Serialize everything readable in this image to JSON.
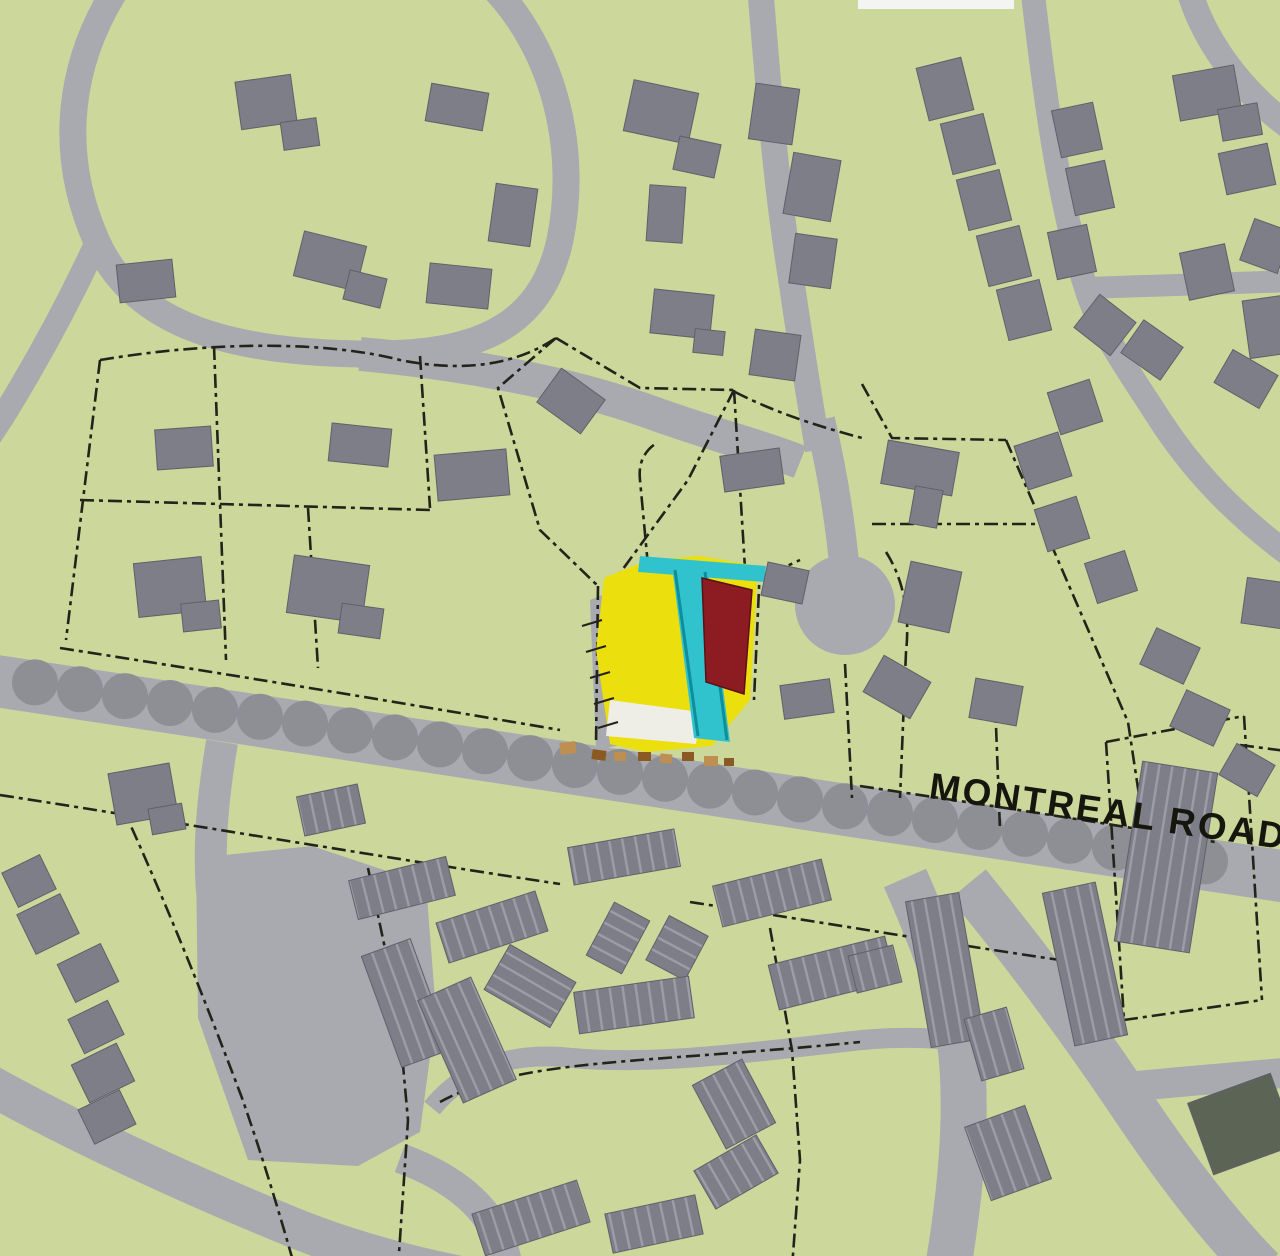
{
  "map": {
    "road_label": "MONTREAL ROAD",
    "colors": {
      "background": "#ccd79b",
      "road": "#a9a9b0",
      "building": "#7e7e88",
      "building_stroke": "#60606a",
      "townhouse_stripe": "#9d9da7",
      "tree": "#8e8e95",
      "parcel_line": "#23231a",
      "site_yellow": "#ecdf0e",
      "site_cyan": "#31c3cd",
      "site_teal_edge": "#0e8d9b",
      "site_red": "#8d1c22",
      "site_red_edge": "#5a1014",
      "parking_white": "#efeee6",
      "driveway_gray": "#9a9aa0",
      "tick_black": "#222218",
      "tan_dark": "#8a5a22",
      "tan_light": "#bd8f50",
      "dark_building": "#5c6456",
      "top_sliver": "#f4f4f2"
    },
    "roads": [
      {
        "d": "M 118,-14 C 70,60 56,150 97,242 C 136,328 235,352 360,354 C 470,356 540,332 560,240 C 578,152 556,52 492,-14",
        "w": 27
      },
      {
        "d": "M 97,242 C 70,300 38,360 2,418 L -10,436",
        "w": 24
      },
      {
        "d": "M 360,354 C 450,362 560,380 650,412 C 710,434 760,446 800,462",
        "w": 34
      },
      {
        "d": "M 760,-14 C 768,80 775,180 791,278 C 797,320 808,390 818,450",
        "w": 26
      },
      {
        "d": "M 820,420 C 832,470 840,520 845,572",
        "w": 30
      },
      {
        "d": "M 1032,-14 C 1044,90 1058,200 1086,288 C 1099,330 1124,364 1160,420 C 1190,466 1226,506 1280,548 L 1294,558",
        "w": 24
      },
      {
        "d": "M 1086,288 C 1150,286 1220,283 1294,281",
        "w": 22
      },
      {
        "d": "M 1188,-14 C 1202,38 1240,92 1294,130",
        "w": 26
      },
      {
        "d": "M -10,680 L 1294,878",
        "w": 52
      },
      {
        "d": "M -10,1085 C 80,1135 190,1185 280,1222 C 350,1252 420,1268 470,1278",
        "w": 40
      },
      {
        "d": "M 400,1158 C 460,1180 500,1215 508,1268",
        "w": 30
      },
      {
        "d": "M 222,742 C 214,790 208,840 212,892",
        "w": 32
      },
      {
        "d": "M 905,878 C 930,935 950,985 960,1042 C 968,1105 962,1185 948,1268",
        "w": 46
      },
      {
        "d": "M 432,1108 C 470,1062 520,1052 572,1058 C 660,1066 770,1050 862,1040 C 905,1036 940,1038 962,1042",
        "w": 20
      },
      {
        "d": "M 968,884 C 1022,950 1076,1022 1126,1096 C 1170,1162 1216,1224 1262,1270",
        "w": 46
      },
      {
        "d": "M 1120,1088 C 1170,1082 1230,1078 1294,1072",
        "w": 30
      }
    ],
    "road_areas": [
      "M 196,858 L 312,846 L 426,884 L 436,1012 L 420,1132 L 358,1166 L 248,1160 L 198,1018 Z",
      "M 590,600 L 610,592 L 626,744 L 596,750 Z"
    ],
    "culdesac": {
      "cx": 845,
      "cy": 605,
      "r": 50
    },
    "trees": {
      "count": 27,
      "x0": 35,
      "dx": 45,
      "y0": 677,
      "slope": 0.153,
      "r": 23
    },
    "parcel_lines": [
      "M 100,360 C 220,340 330,342 400,360 C 470,374 520,362 556,338",
      "M 100,360 L 66,640",
      "M 60,648 C 240,676 420,706 560,730",
      "M 214,346 L 226,660",
      "M 420,356 L 430,508",
      "M 80,500 L 430,510",
      "M 308,508 L 318,668",
      "M 556,338 L 498,388 L 540,530 L 598,586",
      "M 556,338 L 640,388 L 734,390",
      "M 734,390 L 688,480 L 612,584",
      "M 734,390 L 742,520 L 746,585",
      "M 598,586 L 596,745",
      "M 648,566 L 640,480 C 638,462 645,450 658,442",
      "M 760,566 L 754,700",
      "M 746,585 L 800,560",
      "M 886,552 C 904,580 910,615 906,652",
      "M 845,664 L 852,798",
      "M 906,652 L 900,798",
      "M 995,700 L 1000,830",
      "M 862,384 L 892,438 L 1006,440",
      "M 872,524 L 1040,524",
      "M 1006,440 L 1128,722 L 1150,868",
      "M 1240,745 L 1294,752",
      "M 860,786 C 980,804 1100,822 1215,842",
      "M 735,392 C 780,415 825,428 862,438",
      "M 0,795 C 200,826 400,860 560,884",
      "M 690,902 C 820,922 950,944 1060,960",
      "M 120,802 C 165,900 205,1000 242,1098 C 262,1155 280,1215 295,1268",
      "M 368,868 L 398,1010 L 408,1120 L 398,1268",
      "M 770,928 L 792,1050 L 800,1160 L 792,1268",
      "M 440,1102 C 520,1058 640,1064 860,1042",
      "M 1106,742 L 1244,716",
      "M 1244,716 L 1262,1000",
      "M 1106,742 L 1124,1020",
      "M 1124,1020 L 1262,1000"
    ],
    "site": {
      "yellow": "604,578 648,560 700,556 758,566 750,700 712,746 646,752 610,744 596,650",
      "white_parking": "610,700 700,712 696,744 606,736",
      "cyan_bar": "640,556 766,566 764,582 638,572",
      "cyan_band": "672,566 708,570 730,742 694,738",
      "teal_edges": [
        "M 675,570 L 698,736",
        "M 705,572 L 727,740"
      ],
      "red": "702,578 752,590 744,694 706,682",
      "ticks": [
        "M 582,626 L 602,620",
        "M 586,652 L 606,646",
        "M 590,678 L 610,672",
        "M 594,704 L 614,698",
        "M 598,728 L 618,722"
      ],
      "tan": [
        [
          560,
          742,
          16,
          12,
          -8,
          "l"
        ],
        [
          592,
          750,
          14,
          10,
          8,
          "d"
        ],
        [
          614,
          752,
          12,
          9,
          0,
          "l"
        ],
        [
          638,
          752,
          13,
          9,
          0,
          "d"
        ],
        [
          660,
          754,
          12,
          9,
          6,
          "l"
        ],
        [
          682,
          752,
          12,
          9,
          0,
          "d"
        ],
        [
          704,
          756,
          14,
          10,
          0,
          "l"
        ],
        [
          724,
          758,
          10,
          8,
          0,
          "d"
        ]
      ]
    },
    "houses": [
      [
        238,
        78,
        56,
        48,
        -8
      ],
      [
        282,
        120,
        36,
        28,
        -8
      ],
      [
        428,
        88,
        58,
        38,
        10
      ],
      [
        118,
        262,
        56,
        38,
        -6
      ],
      [
        298,
        238,
        64,
        46,
        14
      ],
      [
        346,
        274,
        38,
        30,
        14
      ],
      [
        428,
        266,
        62,
        40,
        6
      ],
      [
        492,
        186,
        42,
        58,
        8
      ],
      [
        628,
        86,
        66,
        52,
        12
      ],
      [
        676,
        140,
        42,
        34,
        12
      ],
      [
        648,
        186,
        36,
        56,
        4
      ],
      [
        652,
        292,
        60,
        44,
        6
      ],
      [
        694,
        330,
        30,
        24,
        6
      ],
      [
        752,
        86,
        44,
        56,
        8
      ],
      [
        788,
        156,
        48,
        62,
        10
      ],
      [
        792,
        236,
        42,
        50,
        8
      ],
      [
        752,
        332,
        46,
        46,
        8
      ],
      [
        544,
        380,
        54,
        42,
        36
      ],
      [
        330,
        426,
        60,
        38,
        6
      ],
      [
        156,
        428,
        56,
        40,
        -4
      ],
      [
        436,
        452,
        72,
        46,
        -5
      ],
      [
        136,
        560,
        68,
        54,
        -6
      ],
      [
        182,
        602,
        38,
        28,
        -6
      ],
      [
        290,
        560,
        76,
        58,
        8
      ],
      [
        340,
        606,
        42,
        30,
        8
      ],
      [
        722,
        452,
        60,
        36,
        -8
      ],
      [
        764,
        566,
        42,
        34,
        12
      ],
      [
        782,
        682,
        50,
        34,
        -8
      ],
      [
        870,
        666,
        54,
        42,
        30
      ],
      [
        972,
        682,
        48,
        40,
        10
      ],
      [
        884,
        446,
        72,
        44,
        10
      ],
      [
        912,
        488,
        28,
        38,
        10
      ],
      [
        904,
        566,
        52,
        62,
        12
      ],
      [
        922,
        62,
        46,
        54,
        -14
      ],
      [
        946,
        118,
        44,
        52,
        -14
      ],
      [
        962,
        174,
        44,
        52,
        -14
      ],
      [
        982,
        230,
        44,
        52,
        -14
      ],
      [
        1002,
        284,
        44,
        52,
        -14
      ],
      [
        1056,
        106,
        42,
        48,
        -12
      ],
      [
        1070,
        164,
        40,
        48,
        -12
      ],
      [
        1052,
        228,
        40,
        48,
        -12
      ],
      [
        1082,
        304,
        46,
        42,
        38
      ],
      [
        1176,
        70,
        62,
        46,
        -10
      ],
      [
        1220,
        106,
        40,
        32,
        -10
      ],
      [
        1222,
        148,
        50,
        42,
        -12
      ],
      [
        1244,
        226,
        44,
        40,
        -70
      ],
      [
        1184,
        248,
        46,
        48,
        -12
      ],
      [
        1246,
        298,
        40,
        58,
        -8
      ],
      [
        1128,
        330,
        48,
        40,
        35
      ],
      [
        1220,
        360,
        52,
        38,
        30
      ],
      [
        1053,
        385,
        44,
        44,
        -18
      ],
      [
        1020,
        438,
        46,
        46,
        -18
      ],
      [
        1040,
        502,
        44,
        44,
        -18
      ],
      [
        1090,
        556,
        42,
        42,
        -18
      ],
      [
        1146,
        636,
        48,
        40,
        25
      ],
      [
        1176,
        698,
        48,
        40,
        25
      ],
      [
        1225,
        752,
        44,
        36,
        30
      ],
      [
        1244,
        580,
        40,
        46,
        8
      ],
      [
        112,
        768,
        62,
        52,
        -10
      ],
      [
        150,
        806,
        34,
        26,
        -10
      ],
      [
        8,
        862,
        42,
        38,
        -26
      ],
      [
        24,
        902,
        48,
        44,
        -26
      ],
      [
        64,
        952,
        48,
        42,
        -26
      ],
      [
        74,
        1008,
        44,
        38,
        -26
      ],
      [
        78,
        1052,
        50,
        42,
        -26
      ],
      [
        84,
        1098,
        46,
        38,
        -26
      ]
    ],
    "townhouse_rows": [
      [
        352,
        868,
        100,
        40,
        -14
      ],
      [
        300,
        790,
        62,
        40,
        -12
      ],
      [
        440,
        906,
        104,
        42,
        -18
      ],
      [
        570,
        838,
        108,
        38,
        -10
      ],
      [
        588,
        918,
        60,
        40,
        -62
      ],
      [
        652,
        926,
        50,
        44,
        -62
      ],
      [
        380,
        944,
        52,
        118,
        -20
      ],
      [
        438,
        984,
        58,
        112,
        -24
      ],
      [
        504,
        948,
        52,
        76,
        -60
      ],
      [
        576,
        984,
        116,
        42,
        -8
      ],
      [
        476,
        1196,
        110,
        44,
        -18
      ],
      [
        608,
        1204,
        92,
        40,
        -12
      ],
      [
        700,
        1150,
        72,
        44,
        -30
      ],
      [
        706,
        1068,
        56,
        72,
        -28
      ],
      [
        772,
        950,
        120,
        46,
        -14
      ],
      [
        716,
        872,
        112,
        42,
        -14
      ],
      [
        852,
        950,
        46,
        38,
        -14
      ],
      [
        918,
        896,
        54,
        148,
        -10
      ],
      [
        1058,
        886,
        54,
        156,
        -12
      ],
      [
        972,
        1012,
        44,
        64,
        -16
      ],
      [
        976,
        1114,
        64,
        78,
        -20
      ],
      [
        1128,
        766,
        76,
        182,
        9
      ]
    ],
    "special_buildings": [
      [
        1198,
        1086,
        88,
        76,
        -20
      ]
    ],
    "top_sliver": {
      "x": 858,
      "y": 0,
      "w": 156,
      "h": 9
    }
  }
}
